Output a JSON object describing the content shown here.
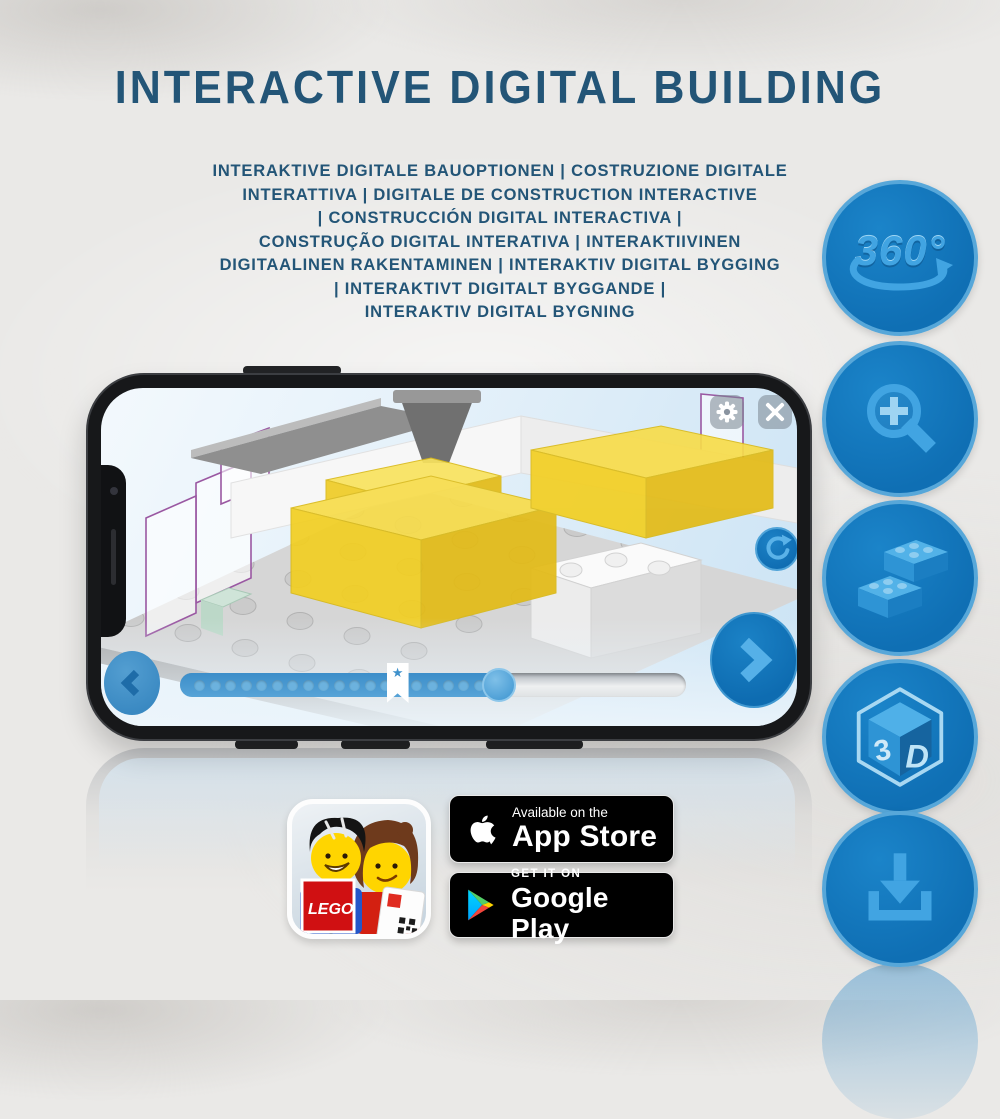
{
  "title": "INTERACTIVE DIGITAL BUILDING",
  "subtitle_lines": [
    "INTERAKTIVE DIGITALE BAUOPTIONEN | COSTRUZIONE DIGITALE",
    "INTERATTIVA | DIGITALE DE CONSTRUCTION INTERACTIVE",
    "| CONSTRUCCIÓN DIGITAL INTERACTIVA |",
    "CONSTRUÇÃO DIGITAL INTERATIVA | INTERAKTIIVINEN",
    "DIGITAALINEN RAKENTAMINEN | INTERAKTIV DIGITAL BYGGING",
    "| INTERAKTIVT DIGITALT BYGGANDE |",
    "INTERAKTIV DIGITAL BYGNING"
  ],
  "features": [
    {
      "id": "rotate-360",
      "label": "360°"
    },
    {
      "id": "zoom-in"
    },
    {
      "id": "bricks"
    },
    {
      "id": "view-3d",
      "labels": {
        "three": "3",
        "dee": "D"
      }
    },
    {
      "id": "download"
    }
  ],
  "phone": {
    "app_ui": {
      "slider": {
        "progress_percent": 63,
        "bookmark_percent": 43,
        "steps_total": 19,
        "bookmark_star": "★"
      }
    }
  },
  "badges": {
    "app_store": {
      "tagline": "Available on the",
      "store": "App Store"
    },
    "google_play": {
      "tagline": "GET IT ON",
      "store": "Google Play"
    },
    "lego_app": {
      "logo_text": "LEGO"
    }
  },
  "colors": {
    "heading_blue": "#235577",
    "icon_circle_fill": "#0f6fb4",
    "icon_circle_border": "#57a7d9",
    "icon_glyph_blue": "#41a4e2",
    "app_button_blue": "#1173b8",
    "highlight_yellow": "#f2cf22",
    "ghost_outline_purple": "#9a58a2",
    "badge_background": "#000000"
  }
}
